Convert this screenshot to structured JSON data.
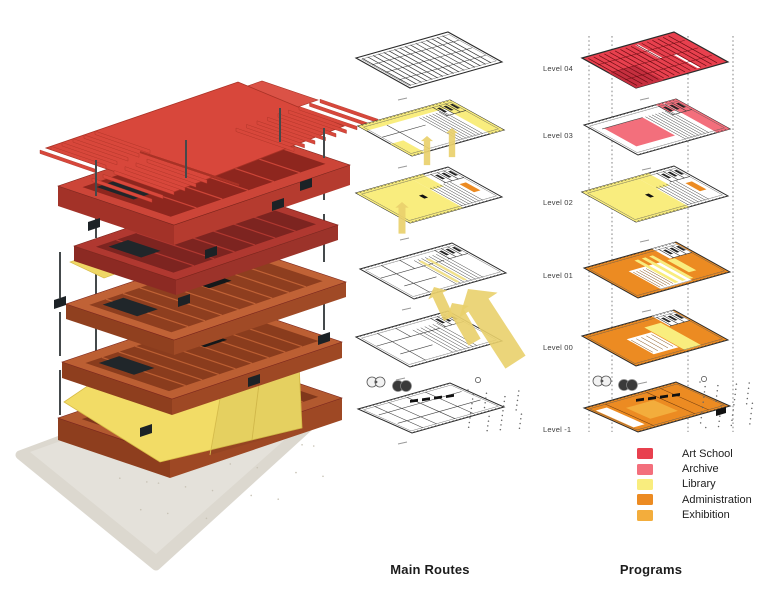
{
  "columns": {
    "routes": {
      "title": "Main Routes"
    },
    "programs": {
      "title": "Programs"
    }
  },
  "levels": [
    {
      "label": "Level 04"
    },
    {
      "label": "Level 03"
    },
    {
      "label": "Level 02"
    },
    {
      "label": "Level 01"
    },
    {
      "label": "Level 00"
    },
    {
      "label": "Level -1"
    }
  ],
  "legend": {
    "items": [
      {
        "key": "art_school",
        "label": "Art School",
        "color": "#E8404E"
      },
      {
        "key": "archive",
        "label": "Archive",
        "color": "#F36F7C"
      },
      {
        "key": "library",
        "label": "Library",
        "color": "#F9ED7E"
      },
      {
        "key": "administration",
        "label": "Administration",
        "color": "#EC8B22"
      },
      {
        "key": "exhibition",
        "label": "Exhibition",
        "color": "#F3AD3C"
      }
    ]
  },
  "colors": {
    "route_arrow": "#E9D06C",
    "plan_line": "#2b2b2b",
    "model_red_roof": "#D8473B",
    "model_red_tray": "#CC4538",
    "model_dark_red_tray": "#B03830",
    "model_terracotta": "#BC5F33",
    "model_yellow_plate": "#F2DC66",
    "model_base": "#DCD8CF"
  }
}
